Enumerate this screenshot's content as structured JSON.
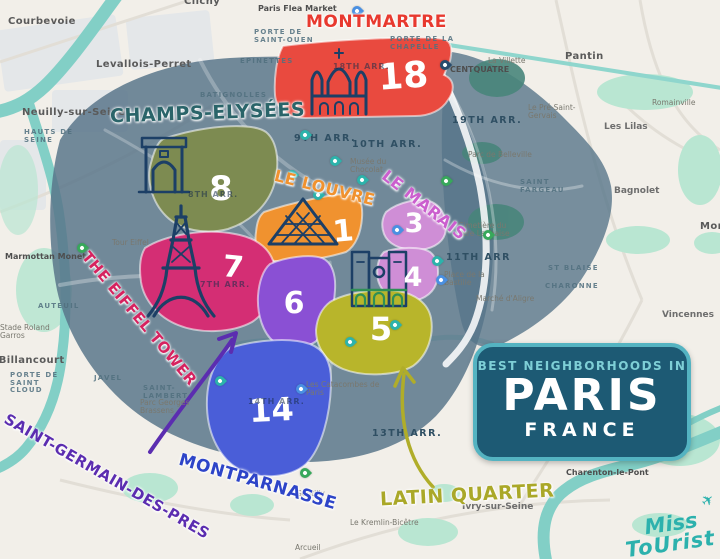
{
  "title_badge": {
    "line1": "BEST NEIGHBORHOODS IN",
    "line2": "PARIS",
    "line3": "FRANCE",
    "bg_color": "#1d5a74",
    "border_color": "#54b3c1"
  },
  "logo": {
    "line1": "Miss",
    "line2": "ToUrist",
    "color": "#2cb1ad"
  },
  "neighborhoods": [
    {
      "name": "Montmartre",
      "label": "MONTMARTRE",
      "number": "18",
      "region_color": "#e94a3f",
      "label_color": "#e8392f",
      "icon": "sacre-coeur-icon"
    },
    {
      "name": "Champs-Élysées",
      "label": "CHAMPS-ELYSÉES",
      "number": "8",
      "region_color": "#7d8b51",
      "label_color": "#2a6469",
      "icon": "arc-de-triomphe-icon"
    },
    {
      "name": "Le Louvre",
      "label": "LE LOUVRE",
      "number": "1",
      "region_color": "#f0922f",
      "label_color": "#f0922f",
      "icon": "louvre-pyramid-icon"
    },
    {
      "name": "Le Marais",
      "label": "LE MARAIS",
      "number": "3",
      "number2": "4",
      "region_color": "#cf8ed6",
      "label_color": "#cb5ece",
      "icon": null
    },
    {
      "name": "The Eiffel Tower",
      "label": "THE EIFFEL TOWER",
      "number": "7",
      "region_color": "#d42e74",
      "label_color": "#d6225f",
      "icon": "eiffel-tower-icon"
    },
    {
      "name": "Saint-Germain-des-Prés",
      "label": "SAINT-GERMAIN-DES-PRES",
      "number": "6",
      "region_color": "#8a50d4",
      "label_color": "#5b2db0",
      "icon": null
    },
    {
      "name": "Latin Quarter",
      "label": "LATIN QUARTER",
      "number": "5",
      "region_color": "#b8b52b",
      "label_color": "#aaa828",
      "icon": "notre-dame-icon"
    },
    {
      "name": "Montparnasse",
      "label": "MONTPARNASSE",
      "number": "14",
      "region_color": "#4a5ed8",
      "label_color": "#2d44c8",
      "icon": null
    }
  ],
  "map_labels": [
    {
      "t": "Courbevoie",
      "x": 8,
      "y": 16,
      "c": "town"
    },
    {
      "t": "Clichy",
      "x": 184,
      "y": -4,
      "c": "town"
    },
    {
      "t": "Paris Flea Market",
      "x": 258,
      "y": 5,
      "c": "poi-dark"
    },
    {
      "t": "Levallois-Perret",
      "x": 96,
      "y": 59,
      "c": "town"
    },
    {
      "t": "Neuilly-sur-Seine",
      "x": 22,
      "y": 107,
      "c": "town"
    },
    {
      "t": "HAUTS DE SEINE",
      "x": 24,
      "y": 129,
      "c": "district"
    },
    {
      "t": "PORTE DE SAINT-OUEN",
      "x": 254,
      "y": 29,
      "c": "district"
    },
    {
      "t": "PORTE DE LA CHAPELLE",
      "x": 390,
      "y": 36,
      "c": "district"
    },
    {
      "t": "EPINETTES",
      "x": 240,
      "y": 58,
      "c": "district"
    },
    {
      "t": "BATIGNOLLES",
      "x": 200,
      "y": 92,
      "c": "district"
    },
    {
      "t": "Pantin",
      "x": 565,
      "y": 51,
      "c": "town"
    },
    {
      "t": "La Villette",
      "x": 488,
      "y": 57,
      "c": "poi"
    },
    {
      "t": "CENTQUATRE",
      "x": 450,
      "y": 66,
      "c": "poi-dark"
    },
    {
      "t": "Le Pré-Saint-Gervais",
      "x": 528,
      "y": 104,
      "c": "poi"
    },
    {
      "t": "Les Lilas",
      "x": 604,
      "y": 123,
      "c": "town-sm"
    },
    {
      "t": "Romainville",
      "x": 652,
      "y": 99,
      "c": "poi"
    },
    {
      "t": "19TH ARR.",
      "x": 452,
      "y": 116,
      "c": "arr"
    },
    {
      "t": "9TH ARR.",
      "x": 294,
      "y": 134,
      "c": "arr"
    },
    {
      "t": "10TH ARR.",
      "x": 352,
      "y": 140,
      "c": "arr"
    },
    {
      "t": "Musée du Chocolat",
      "x": 350,
      "y": 158,
      "c": "poi"
    },
    {
      "t": "Parc de Belleville",
      "x": 468,
      "y": 151,
      "c": "poi"
    },
    {
      "t": "SAINT FARGEAU",
      "x": 520,
      "y": 179,
      "c": "district"
    },
    {
      "t": "Bagnolet",
      "x": 614,
      "y": 187,
      "c": "town-sm"
    },
    {
      "t": "Montreuil",
      "x": 700,
      "y": 221,
      "c": "town"
    },
    {
      "t": "Cimetière du Père Lachaise",
      "x": 458,
      "y": 222,
      "c": "poi",
      "w": 62
    },
    {
      "t": "11TH ARR",
      "x": 446,
      "y": 253,
      "c": "arr"
    },
    {
      "t": "Place de la Bastille",
      "x": 444,
      "y": 271,
      "c": "poi"
    },
    {
      "t": "ST BLAISE",
      "x": 548,
      "y": 265,
      "c": "district"
    },
    {
      "t": "CHARONNE",
      "x": 545,
      "y": 283,
      "c": "district"
    },
    {
      "t": "Marché d'Aligre",
      "x": 476,
      "y": 295,
      "c": "poi"
    },
    {
      "t": "Vincennes",
      "x": 662,
      "y": 311,
      "c": "town-sm"
    },
    {
      "t": "Marmottan Monet",
      "x": 5,
      "y": 253,
      "c": "poi-dark"
    },
    {
      "t": "AUTEUIL",
      "x": 38,
      "y": 303,
      "c": "district"
    },
    {
      "t": "Stade Roland Garros",
      "x": 0,
      "y": 324,
      "c": "poi"
    },
    {
      "t": "Boulogne-Billancourt",
      "x": -62,
      "y": 355,
      "c": "town"
    },
    {
      "t": "PORTE DE SAINT CLOUD",
      "x": 10,
      "y": 372,
      "c": "district",
      "w": 58
    },
    {
      "t": "Tour Eiffel",
      "x": 112,
      "y": 239,
      "c": "poi"
    },
    {
      "t": "JAVEL",
      "x": 94,
      "y": 375,
      "c": "district"
    },
    {
      "t": "SAINT-LAMBERT",
      "x": 143,
      "y": 385,
      "c": "district"
    },
    {
      "t": "Parc Georges Brassens",
      "x": 140,
      "y": 399,
      "c": "poi"
    },
    {
      "t": "Les Catacombes de Paris",
      "x": 306,
      "y": 381,
      "c": "poi",
      "w": 90
    },
    {
      "t": "13TH ARR.",
      "x": 372,
      "y": 429,
      "c": "arr"
    },
    {
      "t": "Charenton-le-Pont",
      "x": 566,
      "y": 469,
      "c": "poi-dark"
    },
    {
      "t": "Ivry-sur-Seine",
      "x": 462,
      "y": 503,
      "c": "town-sm"
    },
    {
      "t": "Gentilly",
      "x": 296,
      "y": 490,
      "c": "poi"
    },
    {
      "t": "Le Kremlin-Bicêtre",
      "x": 350,
      "y": 519,
      "c": "poi"
    },
    {
      "t": "Arcueil",
      "x": 295,
      "y": 544,
      "c": "poi"
    },
    {
      "t": "18TH ARR.",
      "x": 333,
      "y": 63,
      "c": "arr-on"
    },
    {
      "t": "8TH ARR.",
      "x": 188,
      "y": 191,
      "c": "arr-on"
    },
    {
      "t": "7TH ARR.",
      "x": 200,
      "y": 281,
      "c": "arr-on"
    },
    {
      "t": "14TH ARR.",
      "x": 248,
      "y": 398,
      "c": "arr-on"
    }
  ],
  "pins": [
    {
      "type": "blue",
      "x": 352,
      "y": 6
    },
    {
      "type": "navy",
      "x": 440,
      "y": 60
    },
    {
      "type": "teal",
      "x": 300,
      "y": 130
    },
    {
      "type": "teal",
      "x": 330,
      "y": 156
    },
    {
      "type": "teal",
      "x": 287,
      "y": 170
    },
    {
      "type": "teal",
      "x": 313,
      "y": 190
    },
    {
      "type": "teal",
      "x": 357,
      "y": 175
    },
    {
      "type": "green",
      "x": 441,
      "y": 176
    },
    {
      "type": "blue",
      "x": 392,
      "y": 225
    },
    {
      "type": "green",
      "x": 483,
      "y": 230
    },
    {
      "type": "teal",
      "x": 432,
      "y": 256
    },
    {
      "type": "blue",
      "x": 436,
      "y": 275
    },
    {
      "type": "green",
      "x": 77,
      "y": 243
    },
    {
      "type": "teal",
      "x": 390,
      "y": 320
    },
    {
      "type": "teal",
      "x": 345,
      "y": 337
    },
    {
      "type": "teal",
      "x": 215,
      "y": 376
    },
    {
      "type": "blue",
      "x": 296,
      "y": 384
    },
    {
      "type": "green",
      "x": 300,
      "y": 468
    }
  ]
}
